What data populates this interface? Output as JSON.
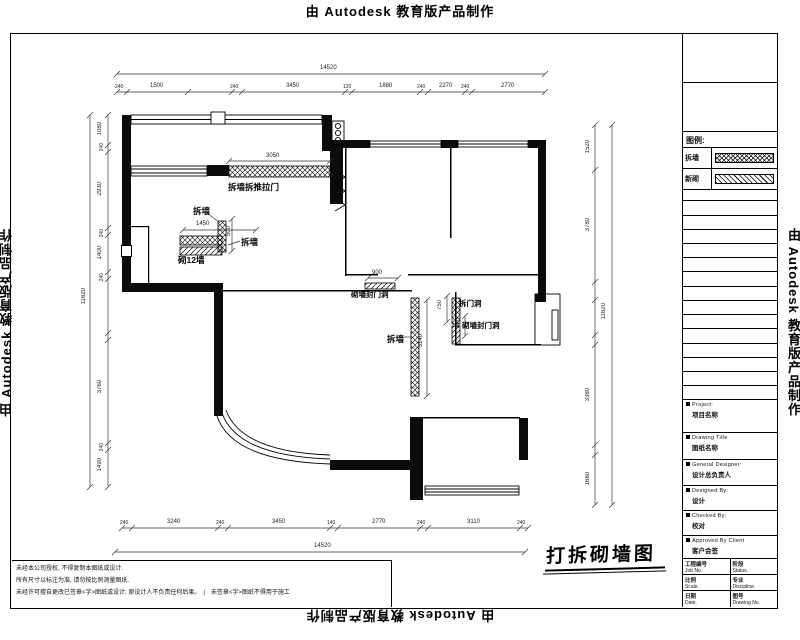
{
  "watermark": {
    "text": "由 Autodesk 教育版产品制作"
  },
  "legend": {
    "title": "图例:",
    "demolish_label": "拆墙",
    "new_label": "新砌",
    "demolish_pattern": "crosshatch",
    "new_pattern": "diagonal-hatch"
  },
  "stamp": {
    "text": "打拆砌墙图"
  },
  "title_block": {
    "project_label": "Project:",
    "project_value": "项目名称",
    "drawing_title_label": "Drawing Title",
    "drawing_title_value": "图纸名称",
    "general_designer_label": "General Designer:",
    "general_designer_value": "设计总负责人",
    "designed_by_label": "Designed By:",
    "designed_by_value": "设计",
    "checked_by_label": "Checked By:",
    "checked_by_value": "校对",
    "approved_label": "Approved By Client",
    "approved_value": "客户会签",
    "job_no_cn": "工程编号",
    "job_no_en": "Job No.",
    "status_cn": "阶段",
    "status_en": "Status.",
    "scale_cn": "比例",
    "scale_en": "Scale.",
    "discipline_cn": "专业",
    "discipline_en": "Discipline.",
    "date_cn": "日期",
    "date_en": "Date.",
    "drawing_no_cn": "图号",
    "drawing_no_en": "Drawing No."
  },
  "notes": [
    "未经本公司授权, 不得复制本图纸或设计.",
    "所有尺寸以标注为准, 请勿按比例测量图纸.",
    "未经许可擅自更改已签章<字>图纸或设计, 原设计人不负责任何后果。　|　未签章<字>图纸不得用于施工"
  ],
  "plan": {
    "annotations": {
      "a1": "拆墙拆推拉门",
      "a2": "拆墙",
      "a3": "拆墙",
      "a4": "砌12墙",
      "a5": "砌墙封门洞",
      "a6": "拆墙",
      "a7": "拆门洞",
      "a8": "砌墙封门洞"
    },
    "inline_dims": {
      "d1": "3050",
      "d2": "1450",
      "d3": "900",
      "d4": "500",
      "d5": "3140",
      "d6": "750",
      "d7": "420"
    },
    "dims": {
      "top_overall": "14520",
      "bottom_overall": "14520",
      "left_overall": "11620",
      "right_overall": "11620",
      "top": [
        "1500",
        "3450",
        "1880",
        "2270",
        "2770"
      ],
      "top_small": [
        "240",
        "240",
        "120",
        "240",
        "240"
      ],
      "bottom": [
        "3240",
        "3450",
        "2770",
        "3110"
      ],
      "bottom_small": [
        "240",
        "240",
        "140",
        "240",
        "240"
      ],
      "left": [
        "1080",
        "2930",
        "1400",
        "3760",
        "1490"
      ],
      "left_small": [
        "240",
        "240",
        "240",
        "240"
      ],
      "right": [
        "1520",
        "3780",
        "3380",
        "1680"
      ]
    }
  }
}
